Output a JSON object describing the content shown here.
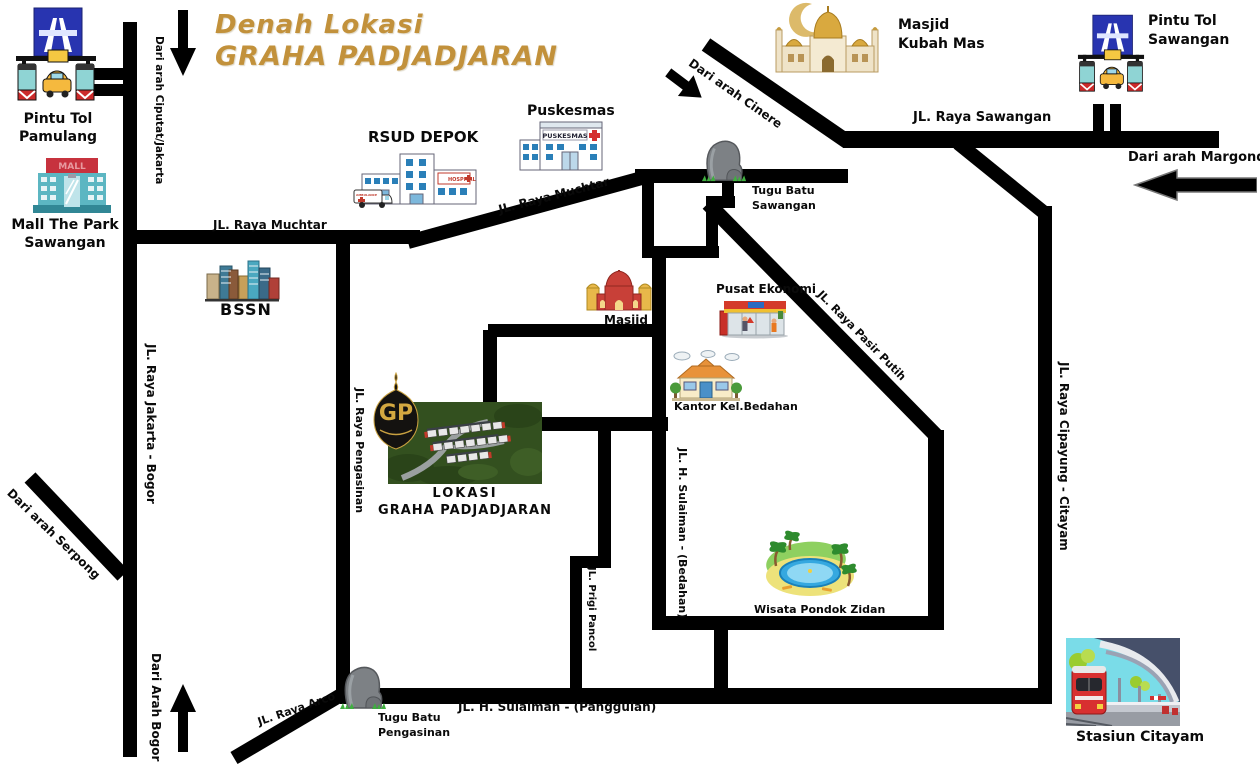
{
  "title": {
    "line1": "Denah Lokasi",
    "line2": "GRAHA PADJADJARAN"
  },
  "colors": {
    "road": "#000000",
    "title_gold": "#c2913b",
    "background": "#ffffff"
  },
  "roads": {
    "sawangan": "JL. Raya Sawangan",
    "muchtar": "JL. Raya Muchtar",
    "jakarta_bogor": "JL. Raya Jakarta - Bogor",
    "pengasinan": "JL. Raya Pengasinan",
    "pasir_putih": "JL. Raya Pasir Putih",
    "cipayung_citayam": "JL. Raya Cipayung - Citayam",
    "sulaiman_bedahan": "JL. H. Sulaiman - (Bedahan)",
    "prigi_pancol": "JL. Prigi Pancol",
    "sulaiman_panggulan": "JL. H. Sulaiman - (Panggulan)",
    "arco": "JL. Raya Arco"
  },
  "directions": {
    "ciputat": "Dari arah Ciputat/Jakarta",
    "cinere": "Dari arah Cinere",
    "margonda": "Dari arah Margonda",
    "serpong": "Dari arah Serpong",
    "bogor": "Dari Arah Bogor"
  },
  "landmarks": {
    "pamulang": {
      "line1": "Pintu Tol",
      "line2": "Pamulang"
    },
    "sawangan_toll": {
      "line1": "Pintu Tol",
      "line2": "Sawangan"
    },
    "kubah_mas": {
      "line1": "Masjid",
      "line2": "Kubah Mas"
    },
    "mall": {
      "line1": "Mall The Park",
      "line2": "Sawangan"
    },
    "rsud": {
      "label": "RSUD DEPOK"
    },
    "puskesmas": {
      "label": "Puskesmas"
    },
    "bssn": {
      "label": "BSSN"
    },
    "tugu_sawangan": {
      "line1": "Tugu Batu",
      "line2": "Sawangan"
    },
    "masjid": {
      "label": "Masjid"
    },
    "pusat_ekonomi": {
      "label": "Pusat Ekonomi"
    },
    "kantor_bedahan": {
      "label": "Kantor Kel.Bedahan"
    },
    "lokasi": {
      "line1": "LOKASI",
      "line2": "GRAHA PADJADJARAN"
    },
    "wisata": {
      "label": "Wisata Pondok Zidan"
    },
    "tugu_pengasinan": {
      "line1": "Tugu Batu",
      "line2": "Pengasinan"
    },
    "stasiun": {
      "label": "Stasiun Citayam"
    }
  },
  "icon_texts": {
    "mall_sign": "MALL",
    "puskesmas_sign": "PUSKESMAS",
    "hospital_sign": "HOSPITAL",
    "ambulance_sign": "AMBULANCE",
    "gp_logo": "GP"
  }
}
